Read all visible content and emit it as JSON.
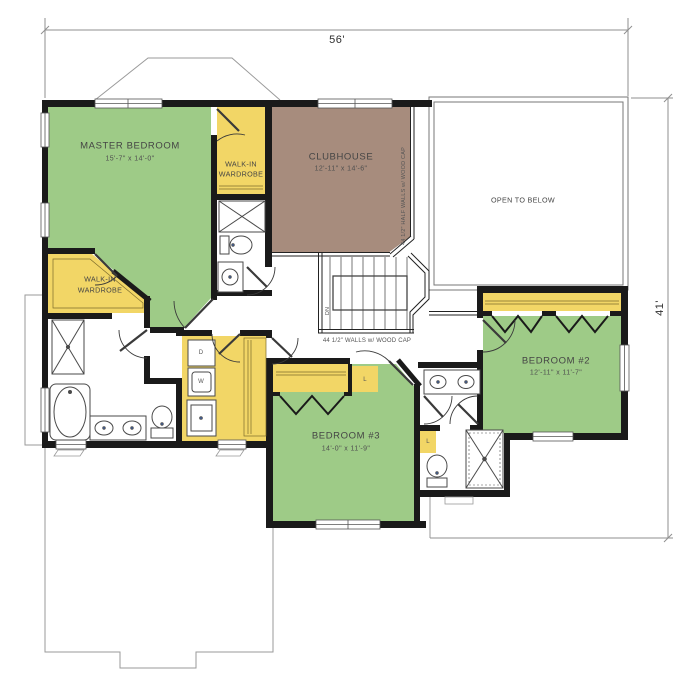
{
  "dimensions": {
    "width_label": "56'",
    "height_label": "41'"
  },
  "rooms": {
    "master": {
      "name": "MASTER BEDROOM",
      "size": "15'-7\" x 14'-0\""
    },
    "clubhouse": {
      "name": "CLUBHOUSE",
      "size": "12'-11\" x 14'-6\""
    },
    "bedroom2": {
      "name": "BEDROOM #2",
      "size": "12'-11\" x 11'-7\""
    },
    "bedroom3": {
      "name": "BEDROOM #3",
      "size": "14'-0\" x 11'-9\""
    },
    "wardrobe_right": {
      "line1": "WALK-IN",
      "line2": "WARDROBE"
    },
    "wardrobe_left": {
      "line1": "WALK-IN",
      "line2": "WARDROBE"
    }
  },
  "labels": {
    "open_to_below": "OPEN TO BELOW",
    "half_walls_note": "44 1/2\" HALF WALLS w/ WOOD CAP",
    "walls_note": "44 1/2\" WALLS w/ WOOD CAP",
    "down": "DN",
    "dryer": "D",
    "washer": "W",
    "linen": "L"
  },
  "colors": {
    "green": "#9ECB87",
    "yellow": "#F2D666",
    "brown": "#A78C7D",
    "wall": "#1a1a1a"
  }
}
